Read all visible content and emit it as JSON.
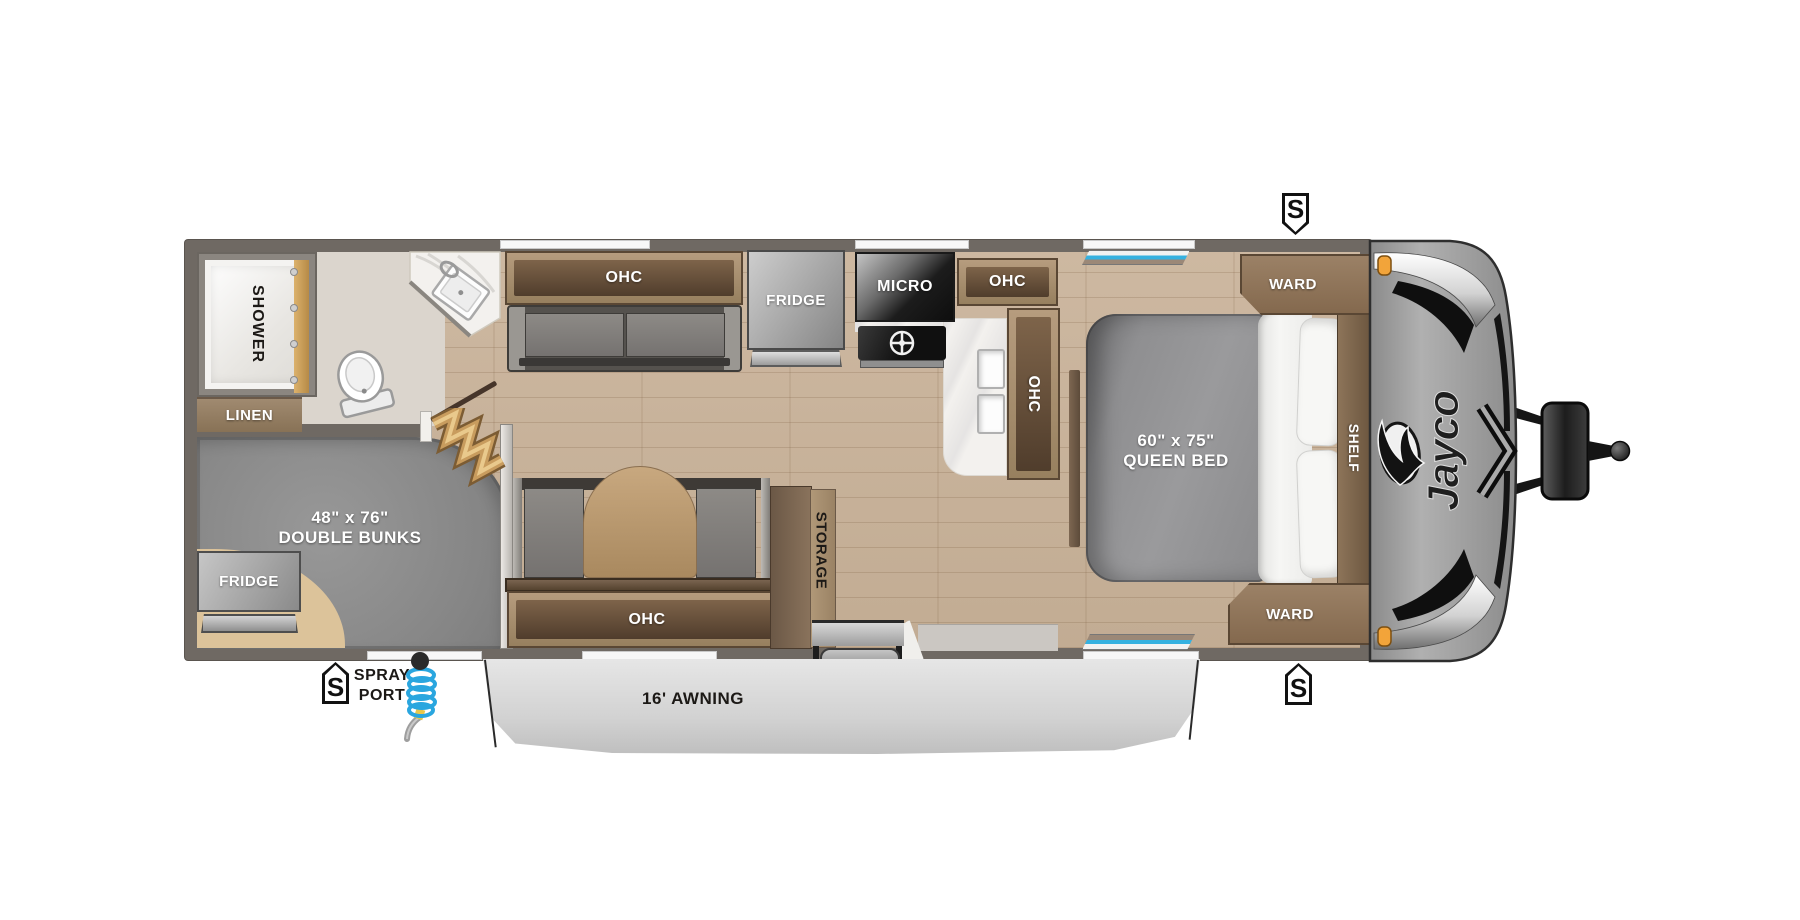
{
  "title": "Jayco travel trailer floor plan",
  "brand": {
    "logo_text": "Jayco"
  },
  "bathroom": {
    "shower_label": "SHOWER",
    "linen_label": "LINEN"
  },
  "bunk_room": {
    "bunks_size": "48\" x 76\"",
    "bunks_label": "DOUBLE BUNKS",
    "fridge_label": "FRIDGE"
  },
  "living_area": {
    "sofa_ohc_label": "OHC",
    "dinette_ohc_label": "OHC",
    "storage_label": "STORAGE"
  },
  "kitchen": {
    "fridge_label": "FRIDGE",
    "micro_label": "MICRO",
    "ohc_upper_label": "OHC",
    "ohc_side_label": "OHC"
  },
  "bedroom": {
    "bed_size": "60\" x 75\"",
    "bed_label": "QUEEN BED",
    "ward_top_label": "WARD",
    "ward_bottom_label": "WARD",
    "shelf_label": "SHELF"
  },
  "exterior": {
    "awning_label": "16' AWNING",
    "spray_port_line1": "SPRAY",
    "spray_port_line2": "PORT",
    "spray_port_badge": "S",
    "speaker_top_badge": "S",
    "speaker_bottom_badge": "S"
  },
  "colors": {
    "wall_gray": "#6f6963",
    "wood_floor": "#c9b49d",
    "bath_floor": "#dbd5cd",
    "bunk_gray": "#8f8f8f",
    "tan_floor": "#dcc39a",
    "cabinet_wood": "#a48b6e",
    "cabinet_dark": "#5d4936",
    "counter_white": "#f3f1ee",
    "accent_blue": "#2fa9dd",
    "marker_orange": "#f2a43a",
    "awning_gray": "#d9d9d9",
    "cap_gray": "#9c9c9c"
  }
}
